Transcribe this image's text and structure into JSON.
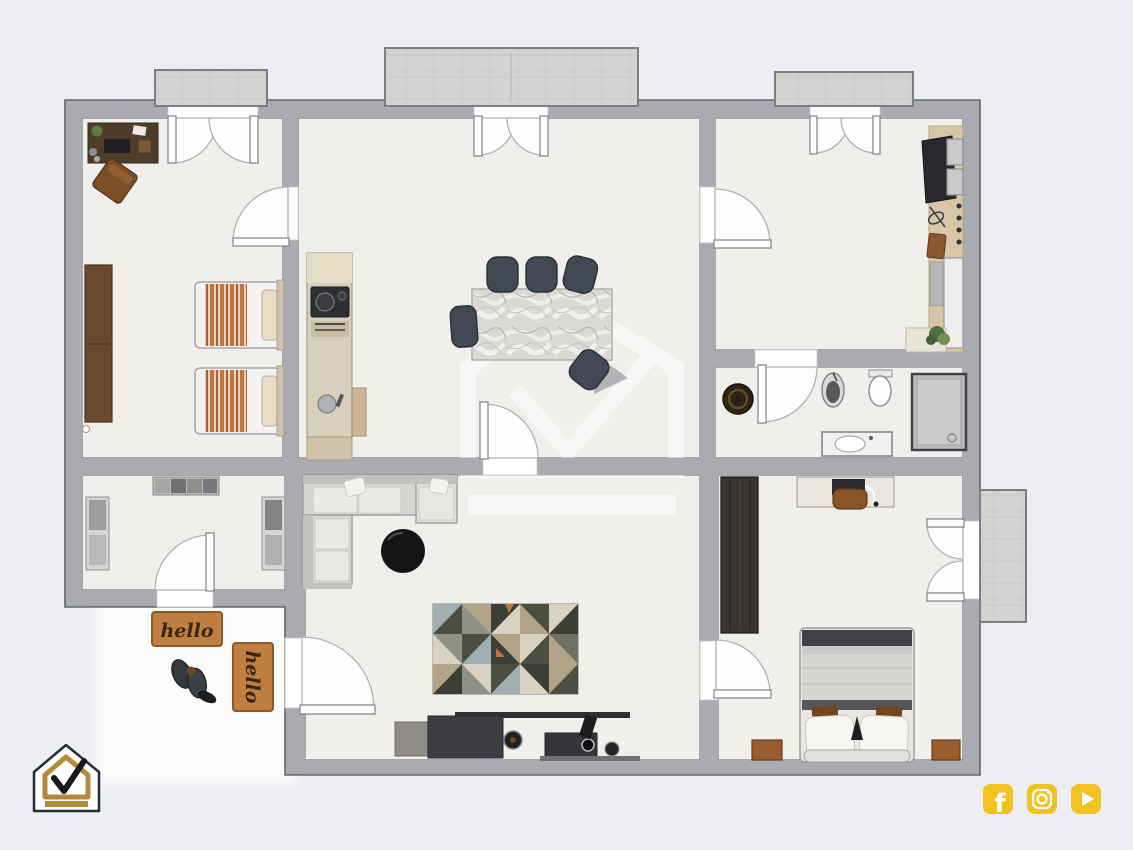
{
  "image": {
    "kind": "2d-floor-plan-render",
    "background_color": "#edeef3"
  },
  "palette": {
    "wall_fill": "#a9abb0",
    "wall_outline": "#63666b",
    "floor": "#f1efeb",
    "door_white": "#fdfdfc",
    "balcony_fill": "#d7d8d6",
    "exterior_porch": "#fbfbfa",
    "accent_social_gold": "#f1c322",
    "logo_gold": "#b5893c",
    "logo_navy": "#262b38",
    "doormat_orange": "#bf7f41",
    "doormat_text_brown": "#3a250e"
  },
  "doormats": [
    {
      "text": "hello",
      "orientation": "horizontal"
    },
    {
      "text": "hello",
      "orientation": "vertical"
    }
  ],
  "brand_logo": {
    "icon": "house-check-logo"
  },
  "watermark": {
    "icon": "house-check-watermark"
  },
  "social_links": [
    {
      "icon": "facebook-icon",
      "glyph": "f",
      "color": "#f1c322"
    },
    {
      "icon": "instagram-icon",
      "color": "#f1c322"
    },
    {
      "icon": "youtube-icon",
      "color": "#f1c322"
    }
  ],
  "rooms": [
    {
      "name": "twin-bedroom",
      "furniture": [
        "desk",
        "desk-chair",
        "wardrobe",
        "twin-bed",
        "twin-bed"
      ]
    },
    {
      "name": "kitchen-dining-room",
      "furniture": [
        "kitchen-counter",
        "cooktop",
        "sink",
        "dining-table",
        "dining-chairs"
      ]
    },
    {
      "name": "dressing-room",
      "furniture": [
        "side-unit",
        "tv-desk",
        "cabinets",
        "tall-cabinet",
        "plant"
      ]
    },
    {
      "name": "bathroom",
      "furniture": [
        "stool",
        "bidet",
        "toilet",
        "vanity-sink",
        "shower"
      ]
    },
    {
      "name": "storage-room",
      "furniture": [
        "shelf-top",
        "shelf-left",
        "shelf-right"
      ]
    },
    {
      "name": "living-room",
      "furniture": [
        "corner-sofa",
        "coffee-table",
        "rug",
        "tv-console",
        "speakers"
      ]
    },
    {
      "name": "master-bedroom",
      "furniture": [
        "wardrobe",
        "desk",
        "desk-chair",
        "double-bed",
        "nightstand",
        "nightstand"
      ]
    },
    {
      "name": "entrance-porch",
      "furniture": [
        "doormat",
        "doormat",
        "boots"
      ]
    }
  ]
}
